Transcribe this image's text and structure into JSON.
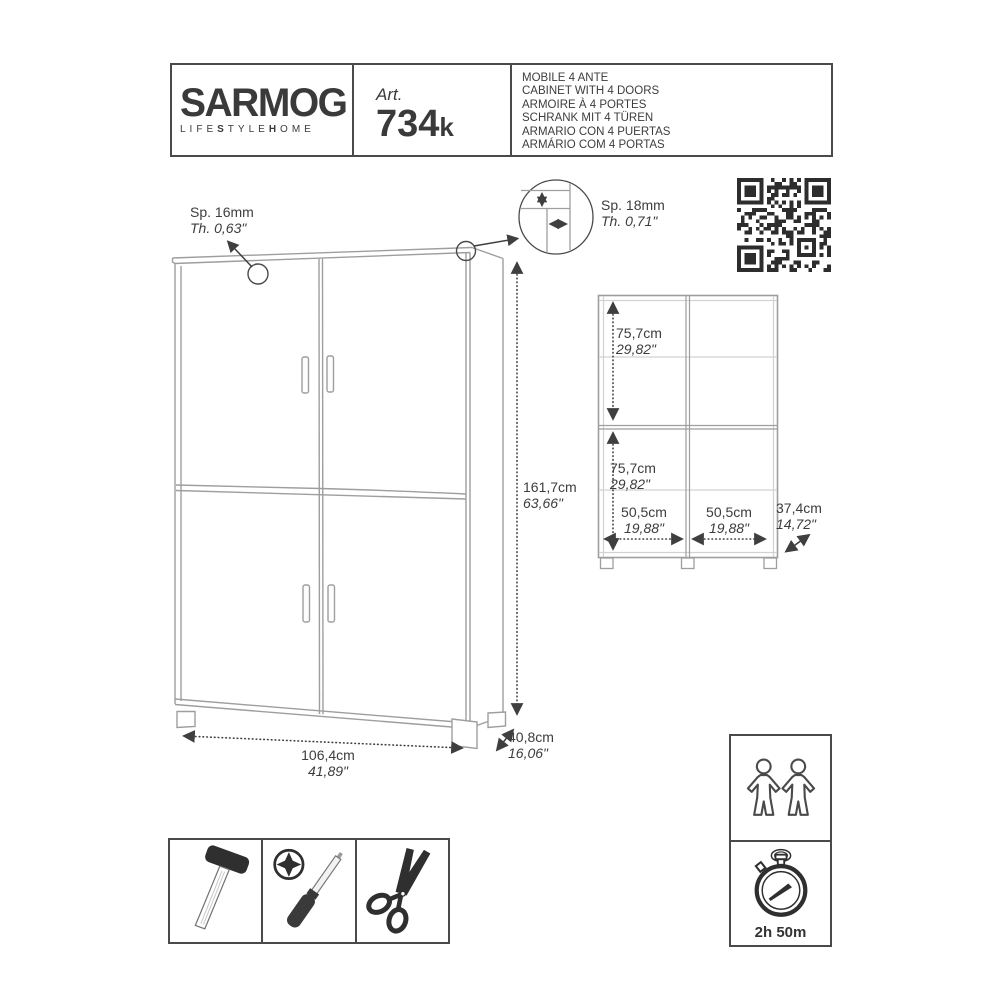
{
  "header": {
    "brand": "SARMOG",
    "tagline": {
      "l1": "LIFE",
      "b1": "S",
      "l2": "TYLE",
      "b2": "H",
      "l3": "OME"
    },
    "art_label": "Art.",
    "art_number": "734",
    "art_suffix": "k",
    "product_names": [
      "MOBILE 4 ANTE",
      "CABINET WITH 4 DOORS",
      "ARMOIRE À 4 PORTES",
      "SCHRANK MIT 4 TÜREN",
      "ARMARIO CON 4 PUERTAS",
      "ARMÁRIO COM 4 PORTAS"
    ]
  },
  "thickness": {
    "door": {
      "metric": "Sp. 16mm",
      "imperial": "Th. 0,63\""
    },
    "panel": {
      "metric": "Sp. 18mm",
      "imperial": "Th. 0,71\""
    }
  },
  "overall": {
    "height": {
      "metric": "161,7cm",
      "imperial": "63,66\""
    },
    "width": {
      "metric": "106,4cm",
      "imperial": "41,89\""
    },
    "depth": {
      "metric": "40,8cm",
      "imperial": "16,06\""
    }
  },
  "front_view": {
    "upper_height": {
      "metric": "75,7cm",
      "imperial": "29,82\""
    },
    "lower_height": {
      "metric": "75,7cm",
      "imperial": "29,82\""
    },
    "left_width": {
      "metric": "50,5cm",
      "imperial": "19,88\""
    },
    "right_width": {
      "metric": "50,5cm",
      "imperial": "19,88\""
    },
    "depth": {
      "metric": "37,4cm",
      "imperial": "14,72\""
    }
  },
  "assembly": {
    "time": "2h 50m",
    "tools": [
      "hammer",
      "phillips-screwdriver",
      "scissors"
    ],
    "people_icon": "two-people-icon",
    "timer_icon": "stopwatch-icon"
  },
  "colors": {
    "line": "#9e9e9e",
    "light_line": "#d2d2d2",
    "dim_line": "#3f3f3f",
    "text": "#3d3d3d",
    "border": "#4a4a4a",
    "qr": "#2d2d2d"
  }
}
